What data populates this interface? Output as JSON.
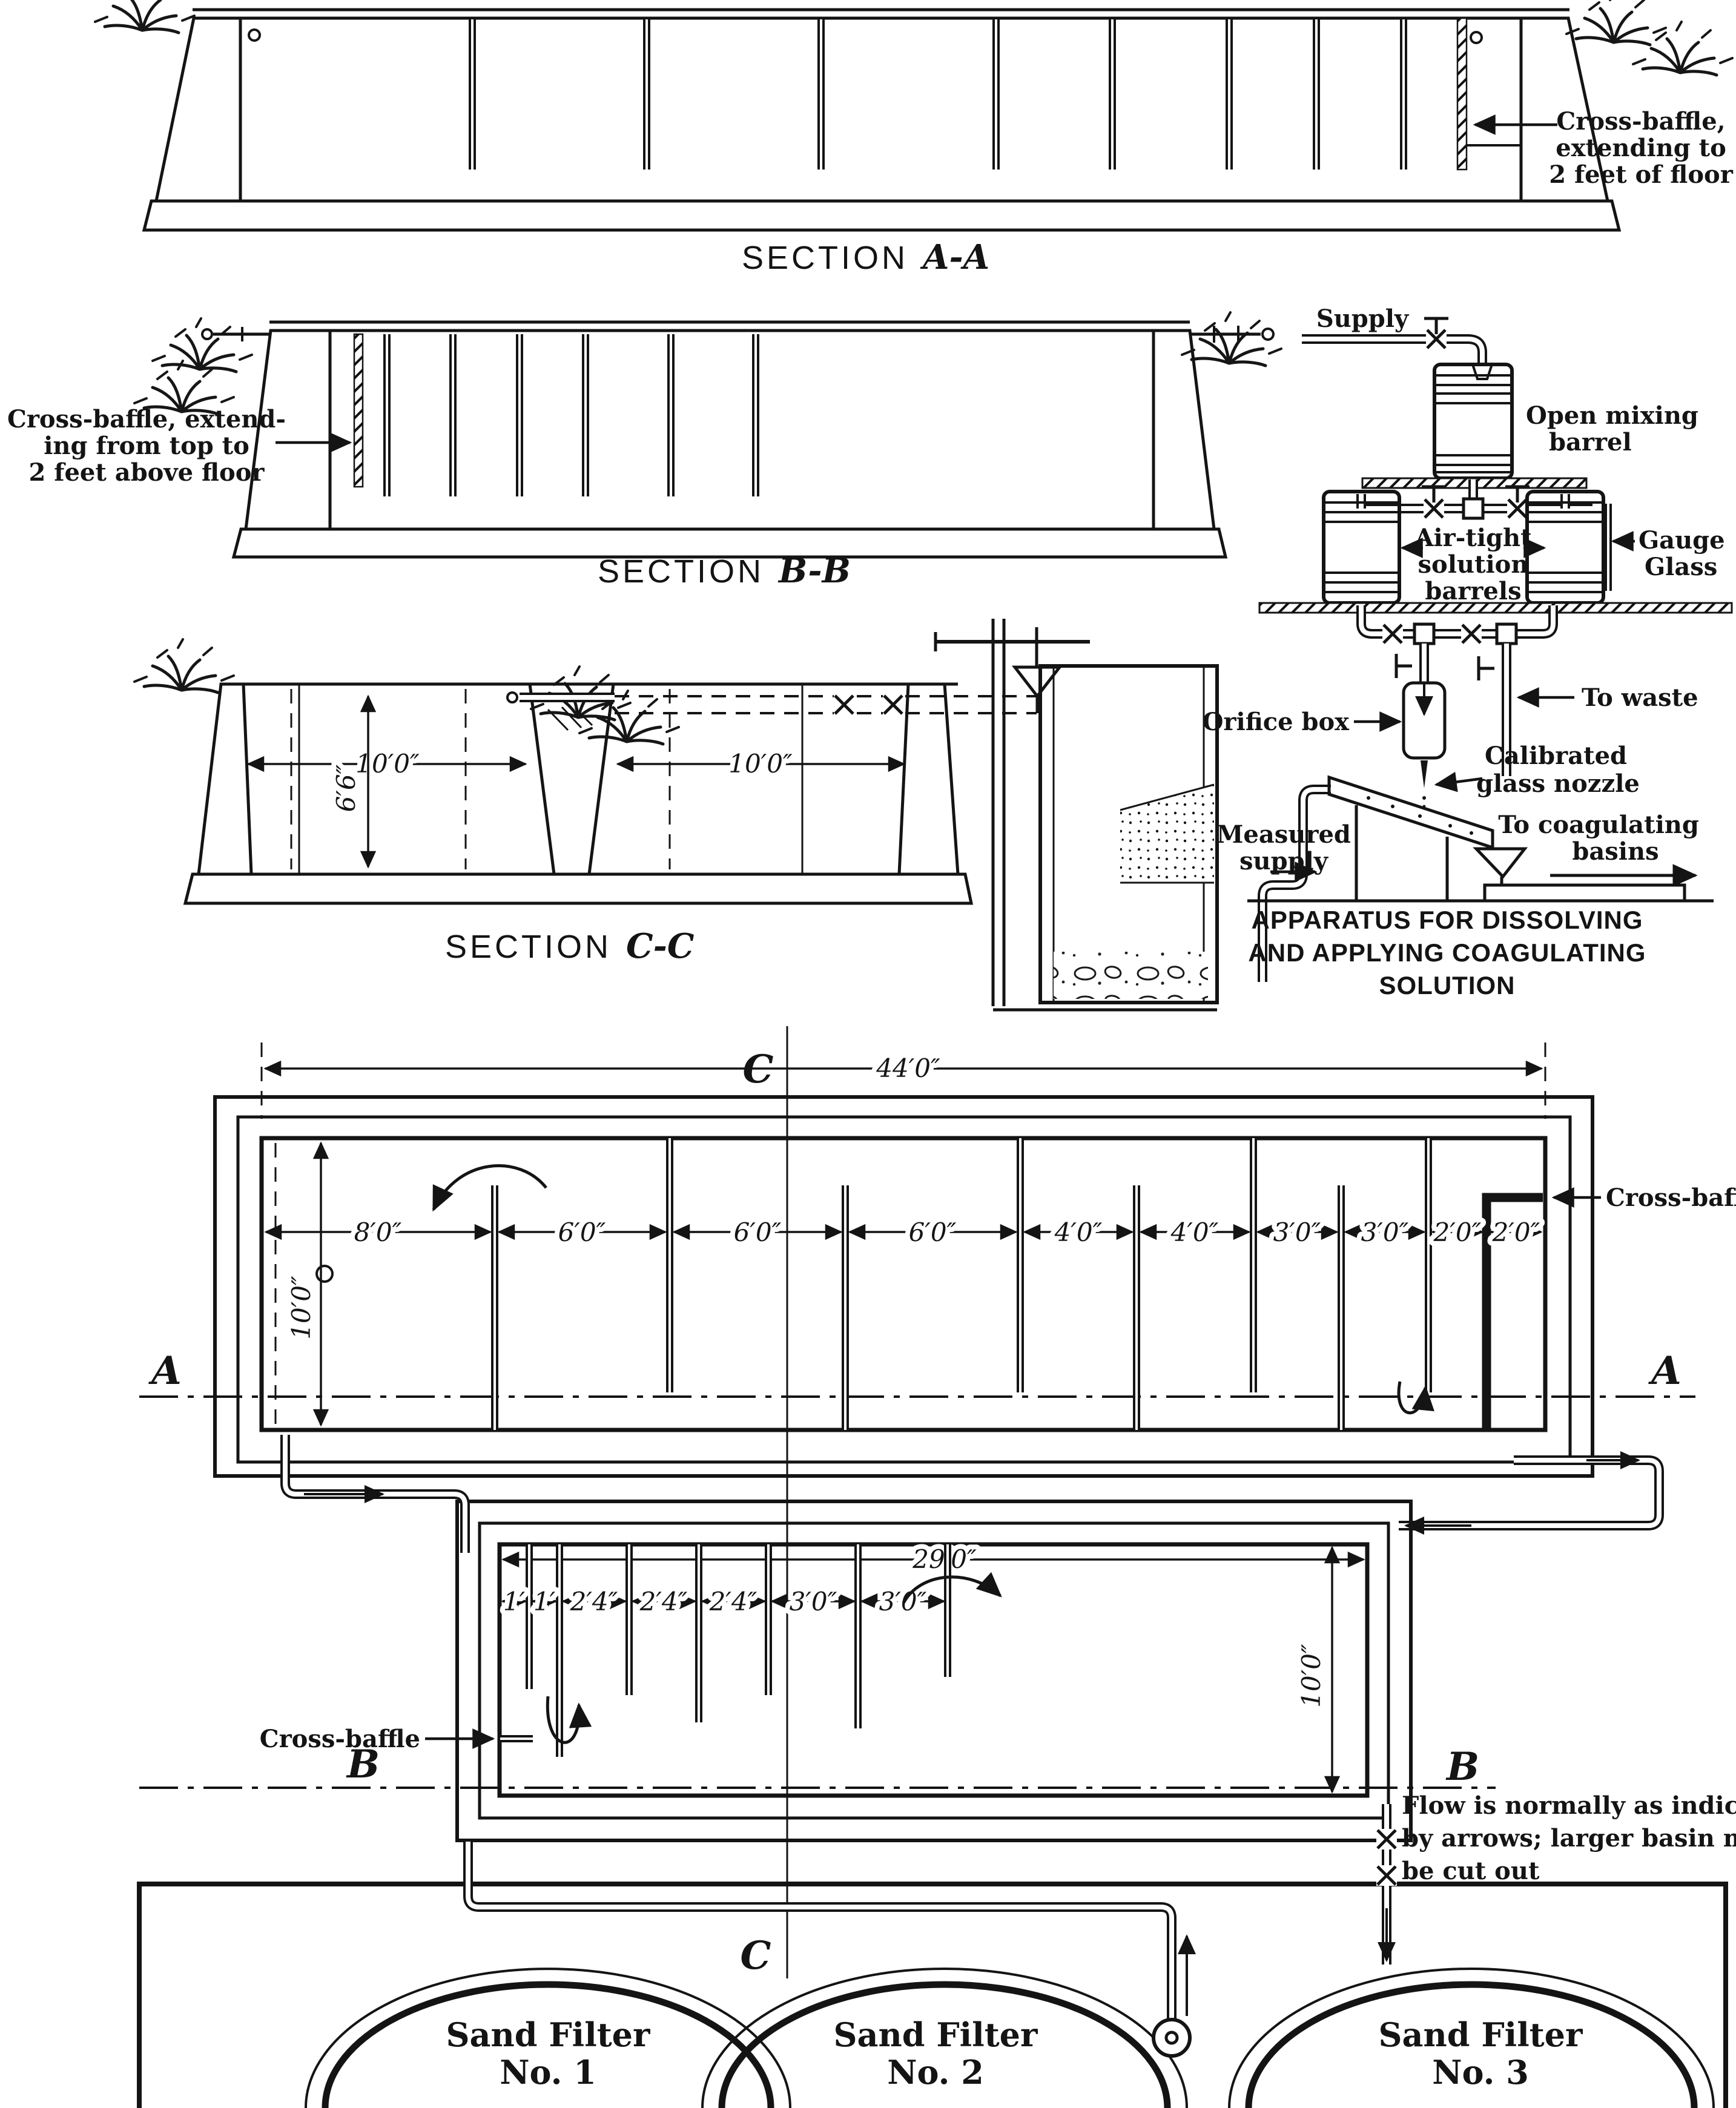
{
  "section_aa": {
    "title_word": "SECTION",
    "title_letters": "A-A",
    "note": [
      "Cross-baffle,",
      "extending to",
      "2 feet of floor"
    ]
  },
  "section_bb": {
    "title_word": "SECTION",
    "title_letters": "B-B",
    "note": [
      "Cross-baffle, extend-",
      "ing from top to",
      "2 feet above floor"
    ]
  },
  "section_cc": {
    "title_word": "SECTION",
    "title_letters": "C-C",
    "width_left": "10′0″",
    "width_right": "10′0″",
    "depth": "6′6″"
  },
  "apparatus": {
    "supply": "Supply",
    "mixing_barrel": [
      "Open mixing",
      "barrel"
    ],
    "solution_barrels": [
      "Air-tight",
      "solution",
      "barrels"
    ],
    "gauge_glass": [
      "Gauge",
      "Glass"
    ],
    "orifice_box": "Orifice box",
    "to_waste": "To waste",
    "nozzle": [
      "Calibrated",
      "glass nozzle"
    ],
    "measured_supply": [
      "Measured",
      "supply"
    ],
    "to_basins": [
      "To coagulating",
      "basins"
    ],
    "caption": [
      "APPARATUS FOR DISSOLVING",
      "AND APPLYING COAGULATING",
      "SOLUTION"
    ]
  },
  "plan_large": {
    "overall": "44′0″",
    "depth": "10′0″",
    "bays": [
      "8′0″",
      "6′0″",
      "6′0″",
      "6′0″",
      "4′0″",
      "4′0″",
      "3′0″",
      "3′0″",
      "2′0″",
      "2′0″"
    ],
    "cross_baffle": "Cross-baffle"
  },
  "plan_small": {
    "overall": "29′0″",
    "depth": "10′0″",
    "bays": [
      "1′",
      "1′",
      "2′4″",
      "2′4″",
      "2′4″",
      "3′0″",
      "3′0″"
    ],
    "cross_baffle": "Cross-baffle",
    "note": [
      "Flow is normally as indicated",
      "by arrows; larger basin may",
      "be cut out"
    ]
  },
  "markers": {
    "a": "A",
    "b": "B",
    "c": "C"
  },
  "filters": [
    {
      "name": "Sand Filter",
      "number": "No. 1"
    },
    {
      "name": "Sand Filter",
      "number": "No. 2"
    },
    {
      "name": "Sand Filter",
      "number": "No. 3"
    }
  ]
}
